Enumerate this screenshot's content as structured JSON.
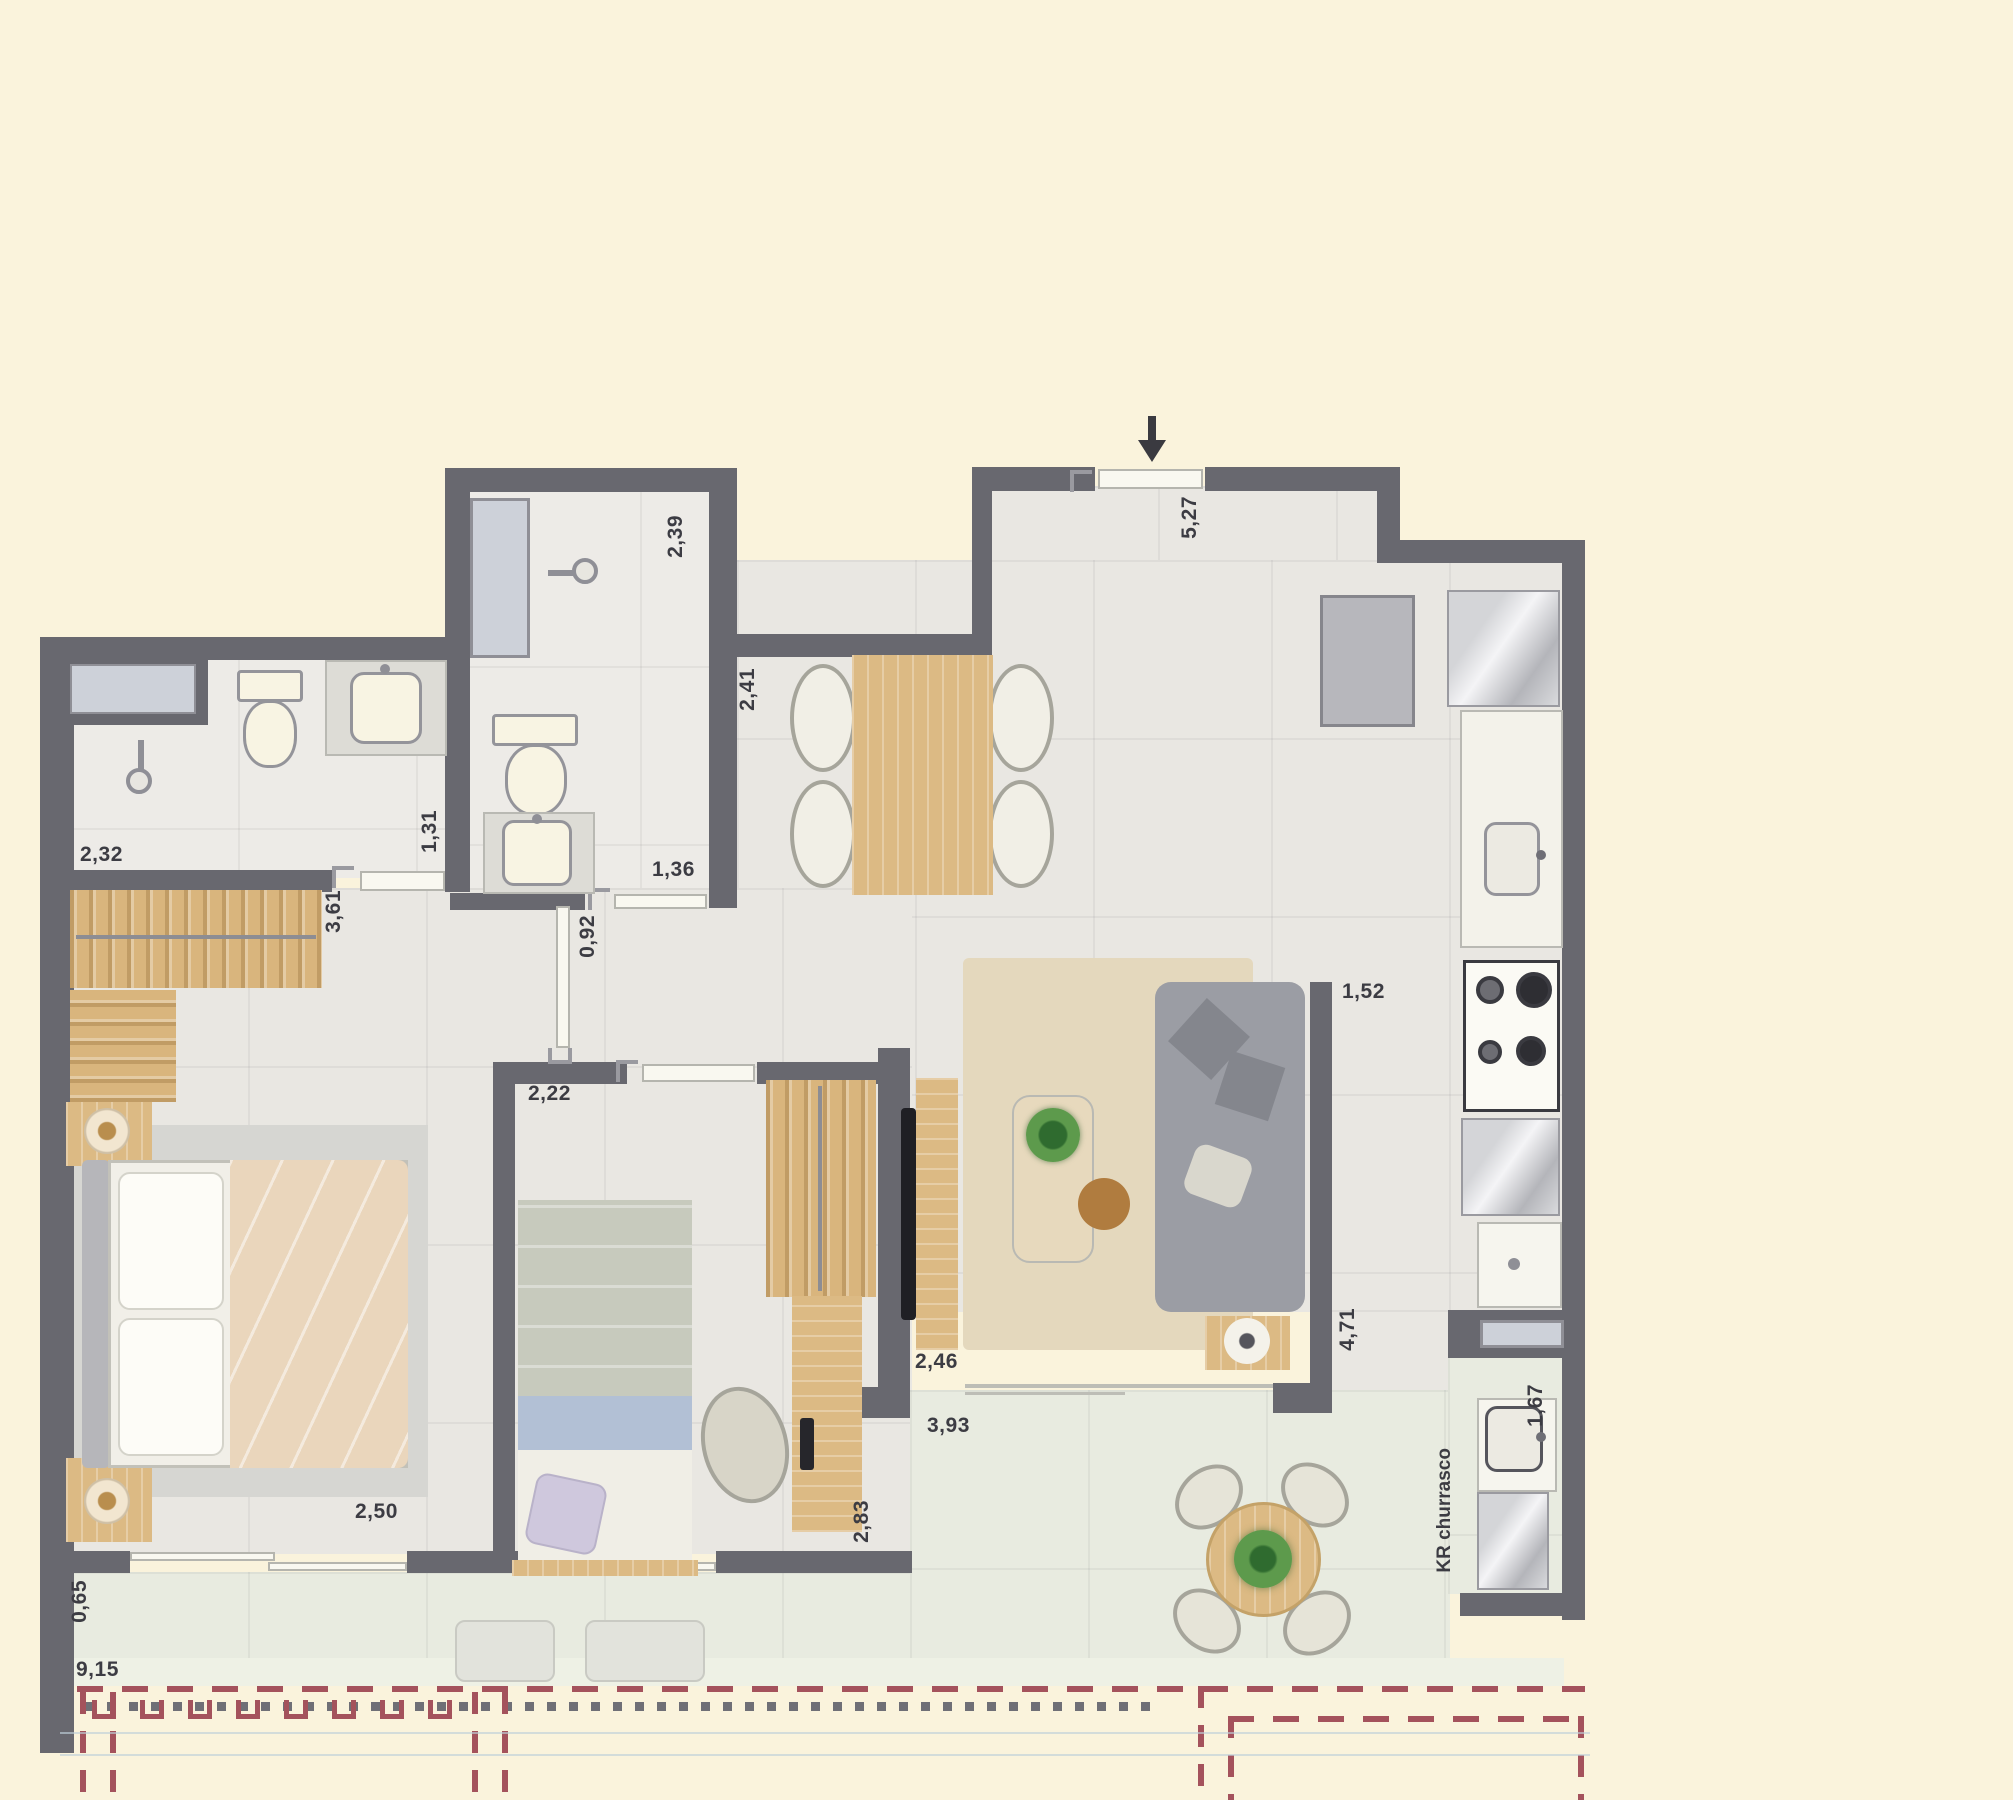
{
  "title": "apartment floor plan",
  "dims": {
    "d239": "2,39",
    "d241": "2,41",
    "d527": "5,27",
    "d232": "2,32",
    "d131": "1,31",
    "d136": "1,36",
    "d092": "0,92",
    "d361": "3,61",
    "d222": "2,22",
    "d152": "1,52",
    "d471": "4,71",
    "d246": "2,46",
    "d393": "3,93",
    "d250": "2,50",
    "d283": "2,83",
    "d065": "0,65",
    "d915": "9,15",
    "d167": "1,67"
  },
  "texts": {
    "kr_area": "KR churrasco"
  },
  "colors": {
    "background": "#faf3dc",
    "wall": "#68686f",
    "floor": "#e9e7e2",
    "terrace": "#e8ebe0",
    "wood": "#dcba84",
    "boundary_red": "#a4525c",
    "sofa_grey": "#9b9da4",
    "duvet_beige": "#ead6bc"
  },
  "icons": {
    "entry_arrow": "arrow-down",
    "shower_head": "shower",
    "lamp": "round-lamp",
    "railing": "u-posts-and-dots",
    "plant": "round-plant"
  }
}
